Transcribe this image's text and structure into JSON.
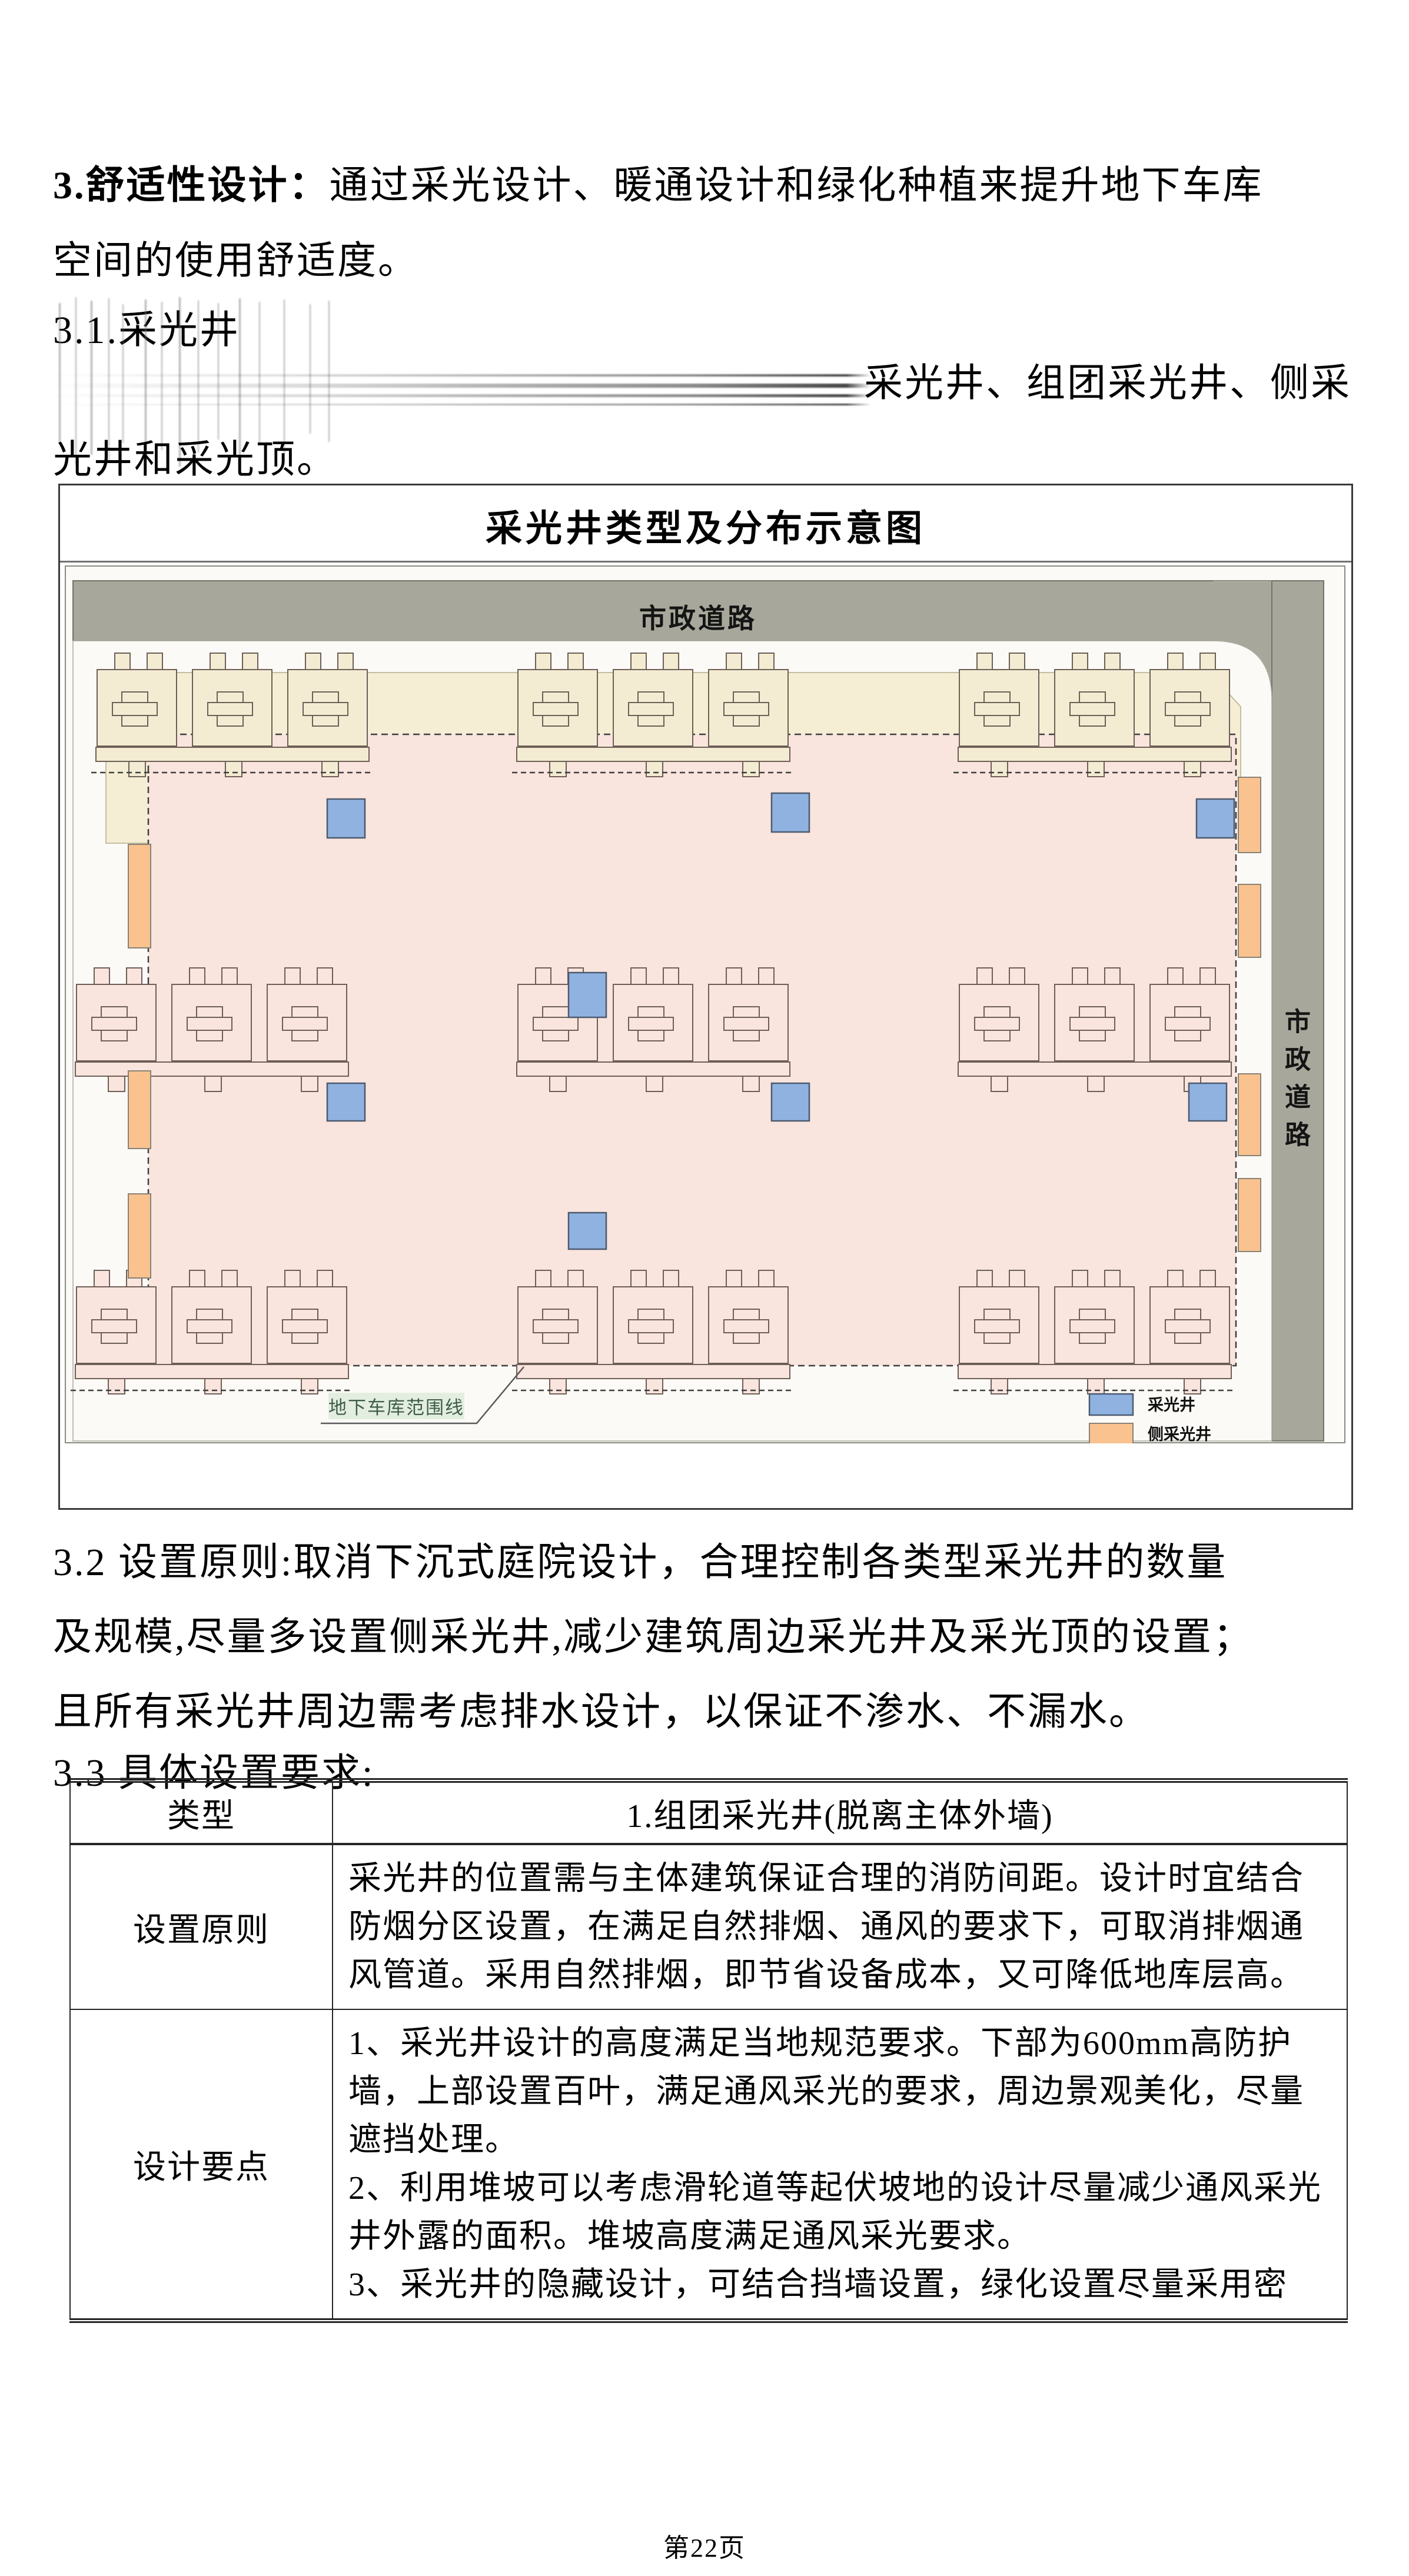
{
  "sections": {
    "s3": {
      "heading_bold": "3.舒适性设计：",
      "line1_rest": "通过采光设计、暖通设计和绿化种植来提升地下车库",
      "line2": "空间的使用舒适度。"
    },
    "s31": "3.1.采光井",
    "corrupted_line": {
      "visible_tail": "采光井、组团采光井、侧采",
      "next_line": "光井和采光顶。"
    },
    "s32": {
      "lines": [
        "3.2 设置原则:取消下沉式庭院设计，合理控制各类型采光井的数量",
        "及规模,尽量多设置侧采光井,减少建筑周边采光井及采光顶的设置；",
        "且所有采光井周边需考虑排水设计，以保证不渗水、不漏水。"
      ]
    },
    "s33": "3.3 具体设置要求:"
  },
  "figure": {
    "title": "采光井类型及分布示意图",
    "road_top": "市政道路",
    "road_right": "市政道路",
    "boundary_label": "地下车库范围线",
    "legend": {
      "lightwell": "采光井",
      "side_lightwell": "侧采光井"
    },
    "colors": {
      "lightwell": "#8fb2e1",
      "side_lightwell": "#f9c28f",
      "road": "#a7a79b",
      "garage": "#f9e4de",
      "podium": "#f5eed4",
      "site": "#fbfaf6"
    }
  },
  "table": {
    "header": {
      "col1": "类型",
      "col2": "1.组团采光井(脱离主体外墙)"
    },
    "rows": [
      {
        "label": "设置原则",
        "content": "采光井的位置需与主体建筑保证合理的消防间距。设计时宜结合防烟分区设置，在满足自然排烟、通风的要求下，可取消排烟通风管道。采用自然排烟，即节省设备成本，又可降低地库层高。"
      },
      {
        "label": "设计要点",
        "content": "1、采光井设计的高度满足当地规范要求。下部为600mm高防护墙，上部设置百叶，满足通风采光的要求，周边景观美化，尽量遮挡处理。\n2、利用堆坡可以考虑滑轮道等起伏坡地的设计尽量减少通风采光井外露的面积。堆坡高度满足通风采光要求。\n3、采光井的隐藏设计，可结合挡墙设置，绿化设置尽量采用密"
      }
    ]
  },
  "page": {
    "footer": "第22页"
  }
}
